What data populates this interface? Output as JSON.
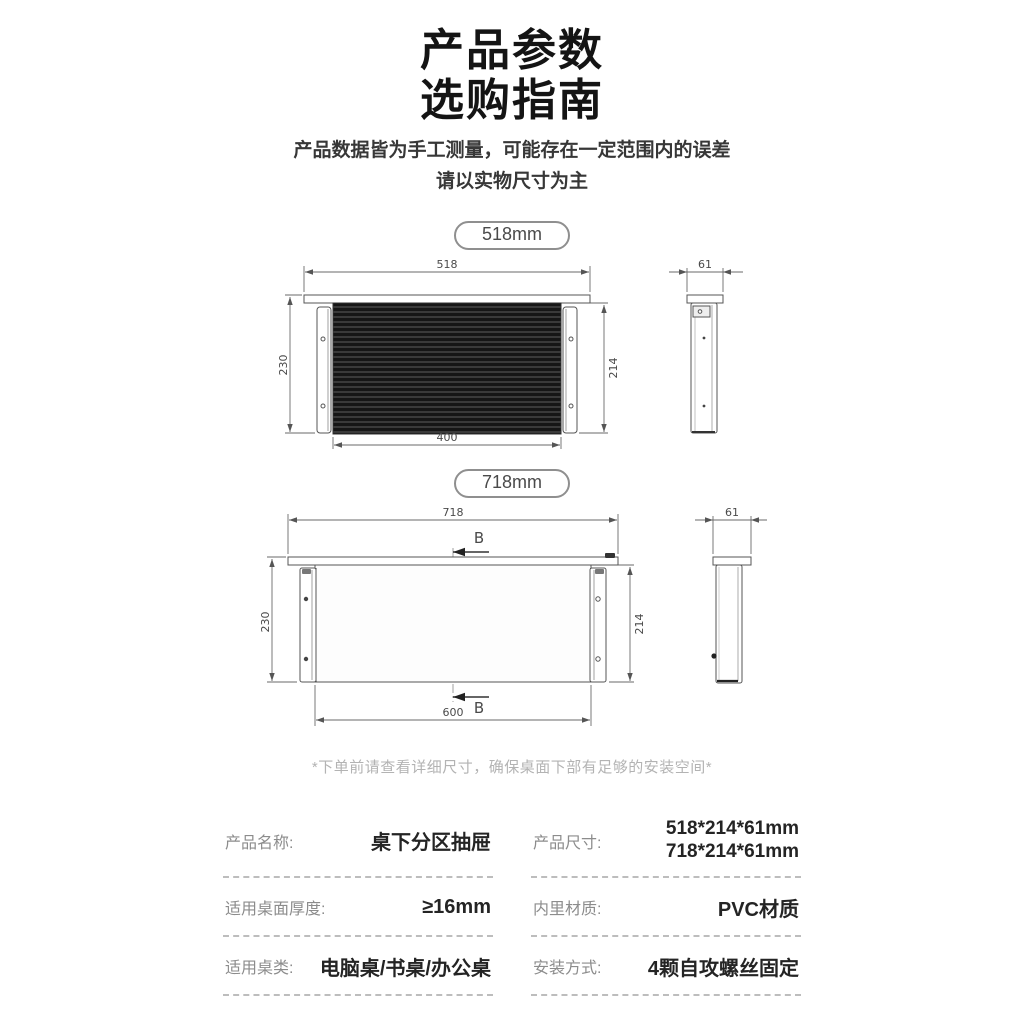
{
  "header": {
    "title_line1": "产品参数",
    "title_line2": "选购指南",
    "subtitle_line1": "产品数据皆为手工测量，可能存在一定范围内的误差",
    "subtitle_line2": "请以实物尺寸为主"
  },
  "size_badges": {
    "small": "518mm",
    "large": "718mm"
  },
  "drawing_518": {
    "top_width": "518",
    "left_height": "230",
    "right_height": "214",
    "bottom_width": "400",
    "side_depth": "61"
  },
  "drawing_718": {
    "top_width": "718",
    "left_height": "230",
    "right_height": "214",
    "bottom_width": "600",
    "side_depth": "61",
    "section_marker": "B"
  },
  "footnote": "*下单前请查看详细尺寸，确保桌面下部有足够的安装空间*",
  "specs": {
    "product_name": {
      "label": "产品名称:",
      "value": "桌下分区抽屉"
    },
    "product_size": {
      "label": "产品尺寸:",
      "value_line1": "518*214*61mm",
      "value_line2": "718*214*61mm"
    },
    "desk_thickness": {
      "label": "适用桌面厚度:",
      "value": "≥16mm"
    },
    "inner_material": {
      "label": "内里材质:",
      "value": "PVC材质"
    },
    "desk_type": {
      "label": "适用桌类:",
      "value": "电脑桌/书桌/办公桌"
    },
    "installation": {
      "label": "安装方式:",
      "value": "4颗自攻螺丝固定"
    }
  },
  "colors": {
    "drawing_line": "#5f5f5f",
    "drawer_body_dark": "#161616",
    "label_gray": "#8c8c8c",
    "footnote_gray": "#b3b3b3"
  }
}
